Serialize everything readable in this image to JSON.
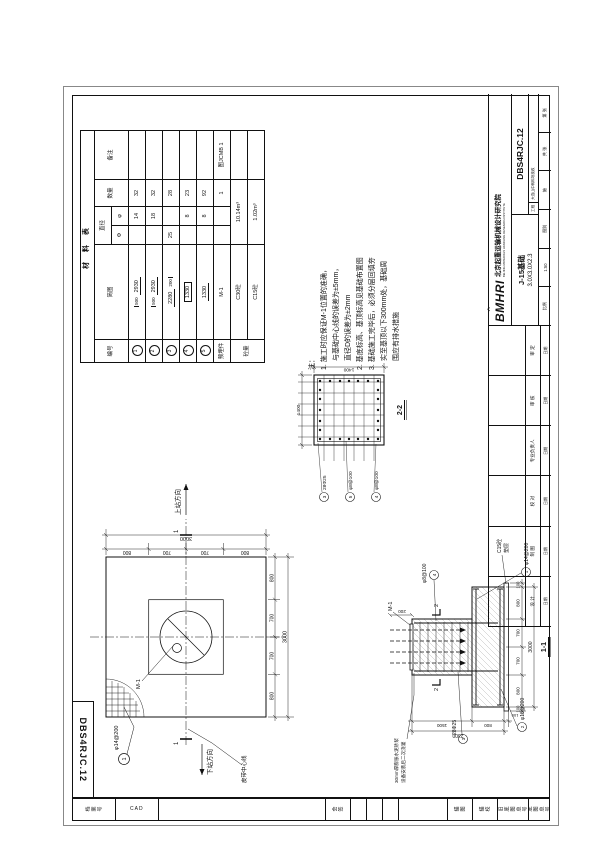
{
  "sheet": {
    "corner_number": "DBS4RJC.12"
  },
  "binding": {
    "c1": "档案号",
    "c2": "CAD",
    "c3": "会签",
    "c4": "描图",
    "c5": "描校",
    "c6": "旧底图总号",
    "c7": "底图总号"
  },
  "material_table": {
    "title": "材 料 表",
    "headers": {
      "no": "编号",
      "sketch": "简图",
      "dia": "直径",
      "dia_sub1": "Φ",
      "dia_sub2": "φ",
      "qty": "数量",
      "remark": "备注"
    },
    "rows": [
      {
        "no": "1",
        "sketch_main": "2930",
        "sketch_sub": "500",
        "d1": "",
        "d2": "14",
        "qty": "32",
        "remark": ""
      },
      {
        "no": "2",
        "sketch_main": "2930",
        "sketch_sub": "500",
        "d1": "",
        "d2": "18",
        "qty": "32",
        "remark": ""
      },
      {
        "no": "3",
        "sketch_main": "2280",
        "sketch_sub": "200",
        "d1": "25",
        "d2": "",
        "qty": "28",
        "remark": ""
      },
      {
        "no": "4",
        "sketch_main": "1330",
        "sketch_sub": "",
        "d1": "",
        "d2": "8",
        "qty": "23",
        "remark": ""
      },
      {
        "no": "5",
        "sketch_main": "1330",
        "sketch_sub": "",
        "d1": "",
        "d2": "8",
        "qty": "92",
        "remark": ""
      },
      {
        "no": "预埋件",
        "sketch_main": "M-1",
        "qty": "1",
        "remark": "图JCMB 1"
      },
      {
        "no": "砼量",
        "sketch_main": "C30砼",
        "vol": "10.14m³"
      },
      {
        "sketch_main": "C15砼",
        "vol": "1.02m³"
      }
    ]
  },
  "notes": {
    "lines": [
      "注：",
      "1. 施工时应保证M-1位置的准确，",
      "　 与基础中心线的误差为±5mm，",
      "　 直径D的误差为±2mm",
      "2. 基底标高、基顶标高见基础布置图",
      "3. 基础施工完毕后，必须分层回填夯",
      "　 实至基顶以下300mm处，基础周",
      "　 围应有排水措施"
    ]
  },
  "plan": {
    "m1": "M-1",
    "bar1": "φ14@200",
    "bar1_no": "1",
    "belt": "皮带中心线",
    "dir_up": "上站方向",
    "dir_down": "下站方向",
    "cut": "1",
    "dims": [
      "800",
      "700",
      "700",
      "800"
    ],
    "total": "3000"
  },
  "section11": {
    "caption": "1-1",
    "m1": "M-1",
    "top_dim": "200",
    "b1": "φ14@200",
    "b1n": "1",
    "b2": "φ18@200",
    "b2n": "2",
    "b3": "28Φ25",
    "b3n": "3",
    "b4": "φ8@100",
    "b4n": "4",
    "pad1": "C15砼",
    "pad2": "垫层",
    "note1": "30mm厚膨胀水泥砂浆",
    "note2": "设备安装后二次浇灌",
    "cut": "2",
    "dims_b": [
      "100",
      "800",
      "700",
      "700",
      "800",
      "100"
    ],
    "total_b": "3000",
    "dims_l": [
      "1500",
      "800",
      "100"
    ],
    "total_l": "2300"
  },
  "section22": {
    "caption": "2-2",
    "dim_top": "1400",
    "dim_right": "1400",
    "b3": "28Φ25",
    "b3n": "3",
    "b5": "φ8@100",
    "b5n": "5",
    "b4": "φ8@100",
    "b4n": "4"
  },
  "title_block": {
    "logo": "BMHRI",
    "institute_cn": "北京起重运输机械设计研究院",
    "institute_en": "BEIJING MATERIALS HANDLING RESEARCH INSTITUTE",
    "number": "DBS4RJC.12",
    "name": "J-15基础",
    "size": "3.0X3.0X2.3",
    "proj_label": "工程",
    "proj": "大连山中转料场技改",
    "scale_label": "比例",
    "scale": "1:50",
    "type_label": "图别",
    "type": "施",
    "pages1": "共 张",
    "pages2": "第 张",
    "date_label": "日期",
    "sig": [
      "设 计",
      "制 图",
      "校 对",
      "专业负责人",
      "审 核",
      "审 定"
    ]
  }
}
